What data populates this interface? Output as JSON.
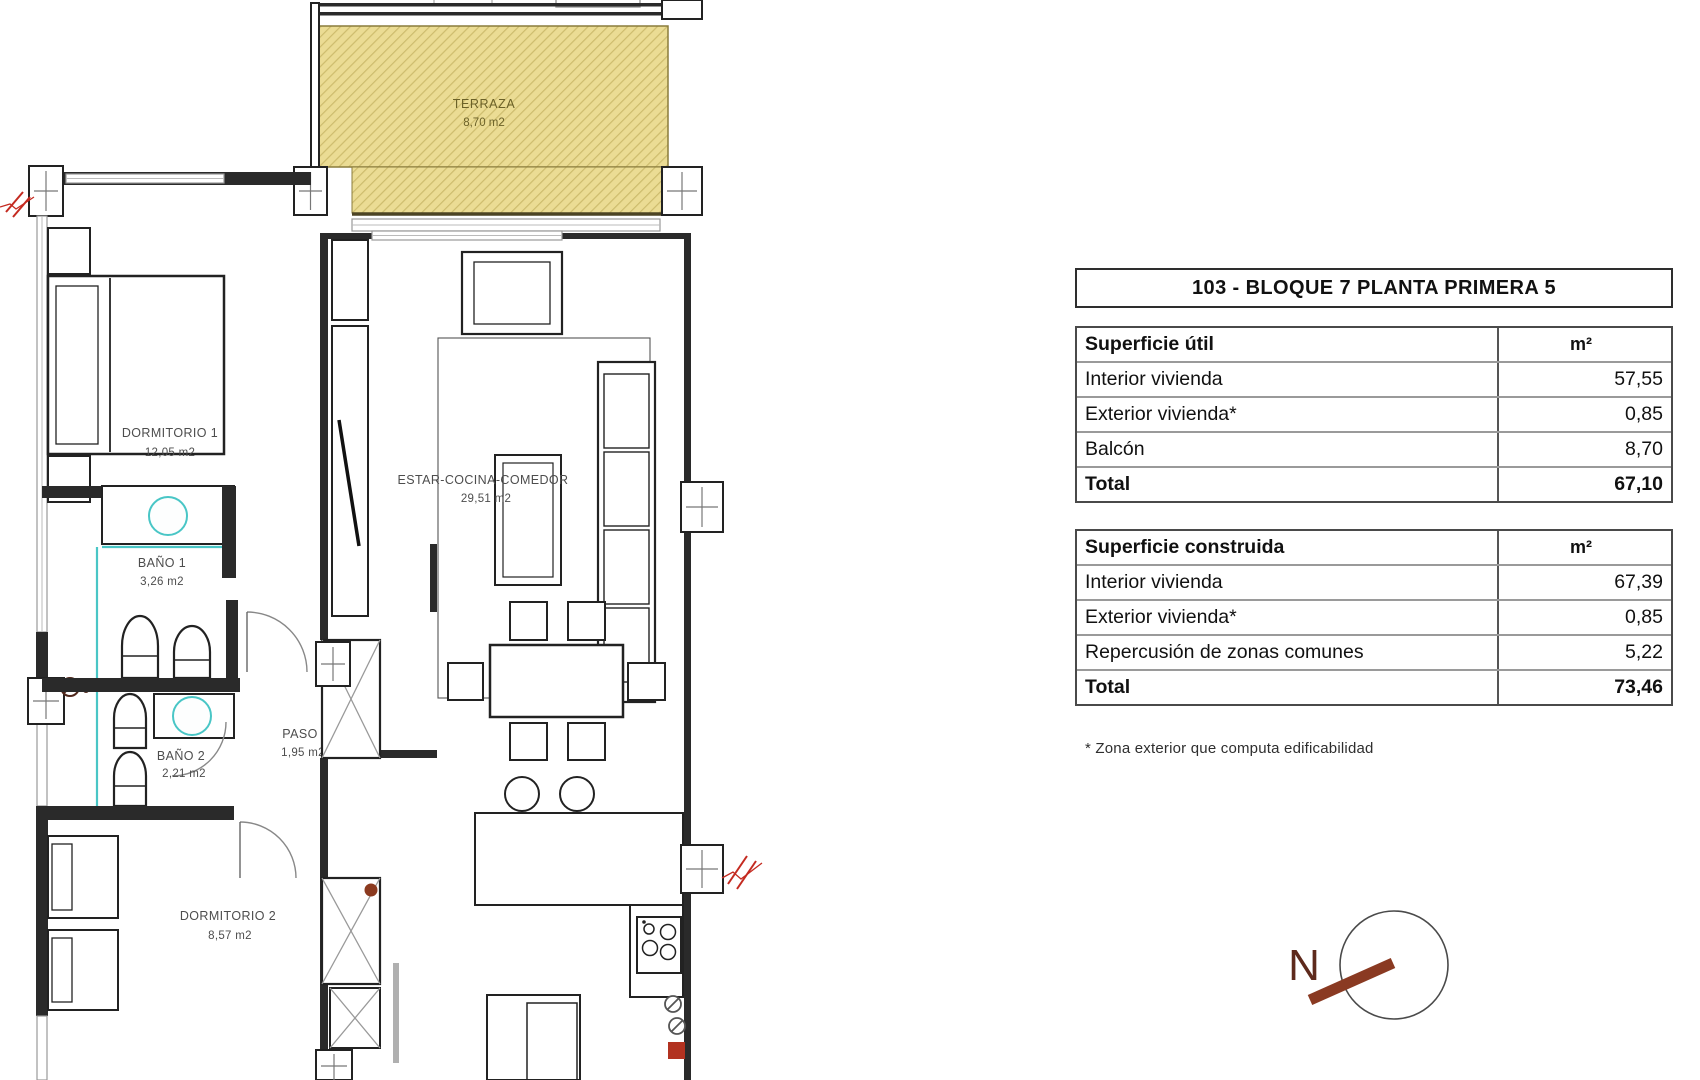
{
  "floor_plan": {
    "terraza": {
      "name": "TERRAZA",
      "area": "8,70 m2"
    },
    "rooms": [
      {
        "name": "DORMITORIO 1",
        "area": "12,05 m2"
      },
      {
        "name": "BAÑO 1",
        "area": "3,26 m2"
      },
      {
        "name": "BAÑO 2",
        "area": "2,21 m2"
      },
      {
        "name": "PASO",
        "area": "1,95 m2"
      },
      {
        "name": "DORMITORIO 2",
        "area": "8,57 m2"
      },
      {
        "name": "ESTAR-COCINA-COMEDOR",
        "area": "29,51 m2"
      }
    ],
    "compass_letter": "N"
  },
  "info_panel": {
    "title": "103 - BLOQUE 7 PLANTA PRIMERA 5",
    "unit": "m²",
    "superficie_util": {
      "header": "Superficie útil",
      "rows": [
        {
          "label": "Interior vivienda",
          "value": "57,55"
        },
        {
          "label": "Exterior vivienda*",
          "value": "0,85"
        },
        {
          "label": "Balcón",
          "value": "8,70"
        }
      ],
      "total_label": "Total",
      "total_value": "67,10"
    },
    "superficie_construida": {
      "header": "Superficie construida",
      "rows": [
        {
          "label": "Interior vivienda",
          "value": "67,39"
        },
        {
          "label": "Exterior vivienda*",
          "value": "0,85"
        },
        {
          "label": "Repercusión de zonas comunes",
          "value": "5,22"
        }
      ],
      "total_label": "Total",
      "total_value": "73,46"
    },
    "footnote": "* Zona exterior que computa edificabilidad"
  },
  "colors": {
    "wall": "#2a2a2a",
    "terraza_fill": "#ebdc94",
    "terraza_hatch": "#cdbc6d",
    "plumbing_cyan": "#49c6c6",
    "break_red": "#c42a20",
    "compass_needle": "#8a3a22",
    "accent_dot": "#8b3a1f"
  }
}
